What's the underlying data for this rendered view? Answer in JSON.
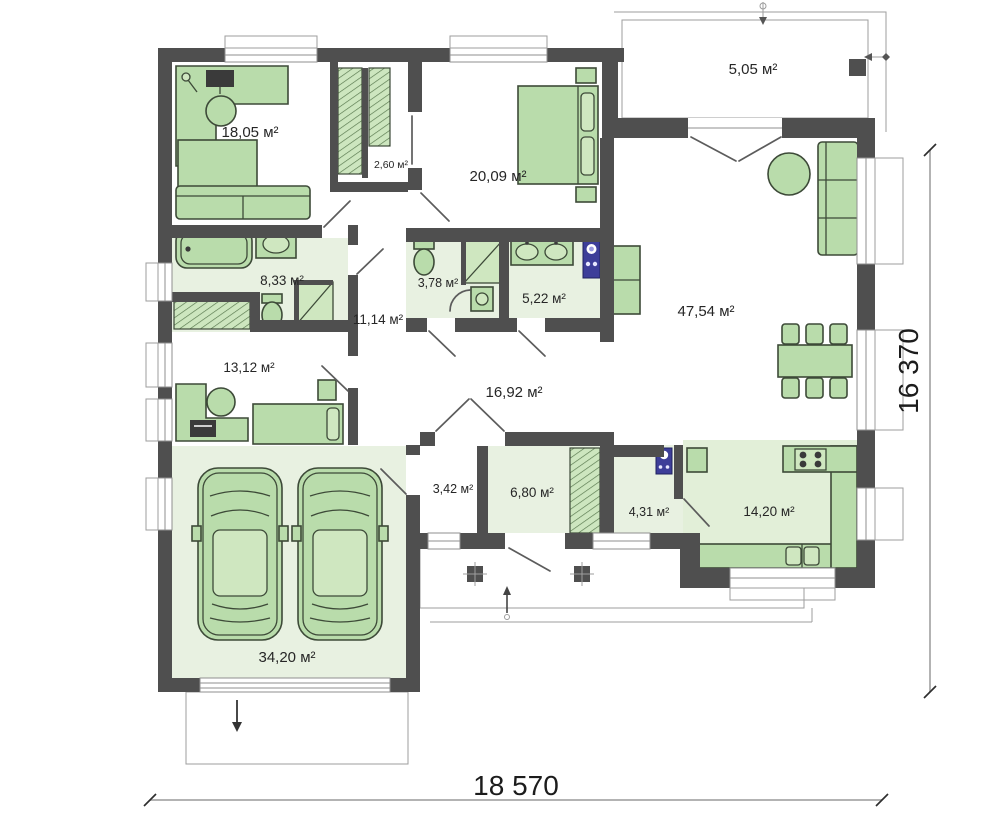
{
  "plan": {
    "title": "single-storey house floor plan",
    "rooms": [
      {
        "id": "bedroom-1",
        "area": "18,05 м²"
      },
      {
        "id": "closet",
        "area": "2,60 м²"
      },
      {
        "id": "bedroom-2",
        "area": "20,09 м²"
      },
      {
        "id": "terrace",
        "area": "5,05 м²"
      },
      {
        "id": "living-room",
        "area": "47,54 м²"
      },
      {
        "id": "shower-room",
        "area": "3,78 м²"
      },
      {
        "id": "bathroom-1",
        "area": "5,22 м²"
      },
      {
        "id": "hall",
        "area": "11,14 м²"
      },
      {
        "id": "bathroom-2",
        "area": "8,33 м²"
      },
      {
        "id": "bedroom-3",
        "area": "13,12 м²"
      },
      {
        "id": "corridor",
        "area": "16,92 м²"
      },
      {
        "id": "entry",
        "area": "3,42 м²"
      },
      {
        "id": "wardrobe-room",
        "area": "6,80 м²"
      },
      {
        "id": "utility",
        "area": "4,31 м²"
      },
      {
        "id": "kitchen",
        "area": "14,20 м²"
      },
      {
        "id": "garage",
        "area": "34,20 м²"
      }
    ],
    "dimensions": {
      "width": "18 570",
      "height": "16 370"
    },
    "colors": {
      "wall": "#4f4f4f",
      "floor_green": "#e8f1e1",
      "furniture_green": "#b9dcab",
      "appliance_blue": "#3d3e99"
    }
  }
}
